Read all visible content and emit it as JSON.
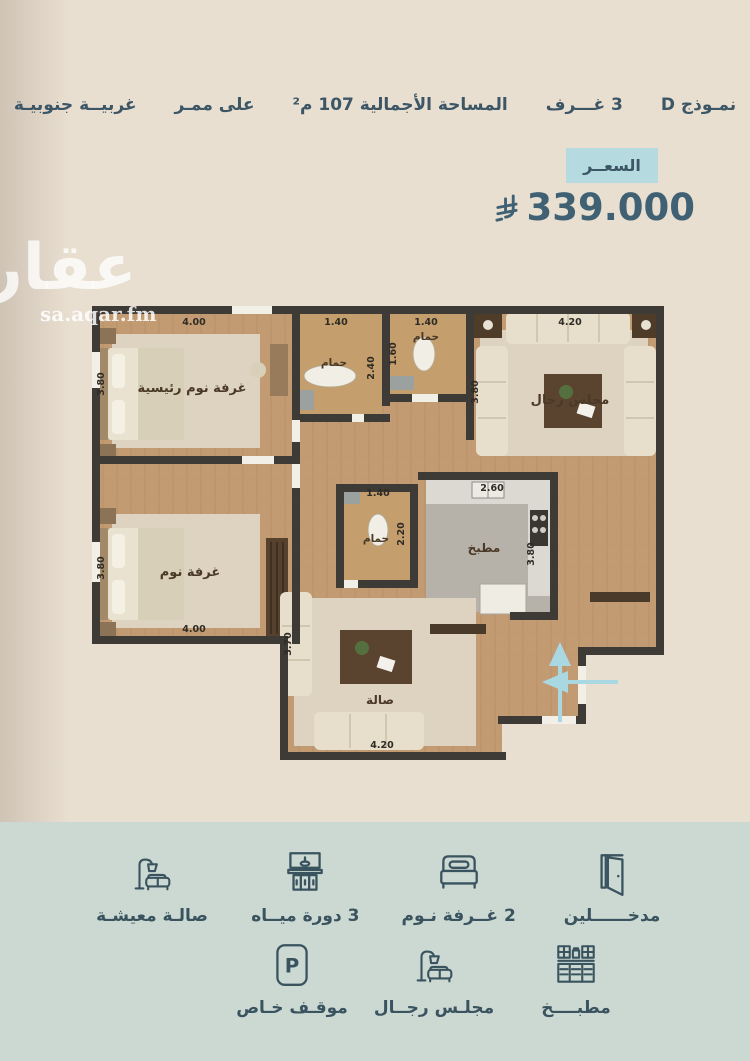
{
  "header": {
    "items": [
      {
        "label": "نمـوذج D"
      },
      {
        "label": "3 غـــرف"
      },
      {
        "label": "المساحة الأجمالية 107 م²"
      },
      {
        "label": "على ممـر"
      },
      {
        "label": "غربيــة جنوبيـة"
      }
    ]
  },
  "price": {
    "badge_label": "السعــر",
    "amount": "339.000",
    "currency_icon": "saudi-riyal-symbol"
  },
  "watermark": {
    "logo": "عقار",
    "site": "sa.aqar.fm"
  },
  "floorplan": {
    "rooms": [
      {
        "label": "غرفة نوم رئيسية"
      },
      {
        "label": "حمام"
      },
      {
        "label": "حمام"
      },
      {
        "label": "مجلس رجال"
      },
      {
        "label": "غرفة نوم"
      },
      {
        "label": "حمام"
      },
      {
        "label": "مطبخ"
      },
      {
        "label": "صالة"
      }
    ],
    "dims": [
      "4.00",
      "3.80",
      "1.40",
      "2.40",
      "1.40",
      "1.60",
      "4.20",
      "3.80",
      "3.80",
      "4.00",
      "1.40",
      "2.20",
      "2.60",
      "3.80",
      "3.70",
      "4.20"
    ],
    "entrance_arrows": [
      "entrance-arrow-up",
      "entrance-arrow-left"
    ]
  },
  "features": {
    "row1": [
      {
        "icon": "door-icon",
        "label": "مدخــــــلين"
      },
      {
        "icon": "bed-icon",
        "label": "2 غــرفة نـوم"
      },
      {
        "icon": "bathroom-vanity-icon",
        "label": "3 دورة ميــاه"
      },
      {
        "icon": "sofa-lamp-icon",
        "label": "صالـة معيشـة"
      }
    ],
    "row2": [
      {
        "icon": "kitchen-icon",
        "label": "مطبــــخ"
      },
      {
        "icon": "majlis-sofa-icon",
        "label": "مجلـس رجــال"
      },
      {
        "icon": "parking-icon",
        "label": "موقـف خـاص"
      }
    ],
    "parking_letter": "P"
  },
  "colors": {
    "beige_bg": "#e9dfd1",
    "sage_bg": "#ccd8d2",
    "ink": "#3c5666",
    "badge_bg": "#b5dbe0",
    "arrow": "#a9d8e3",
    "wall": "#3e3a35",
    "wood": "#c29b73"
  }
}
